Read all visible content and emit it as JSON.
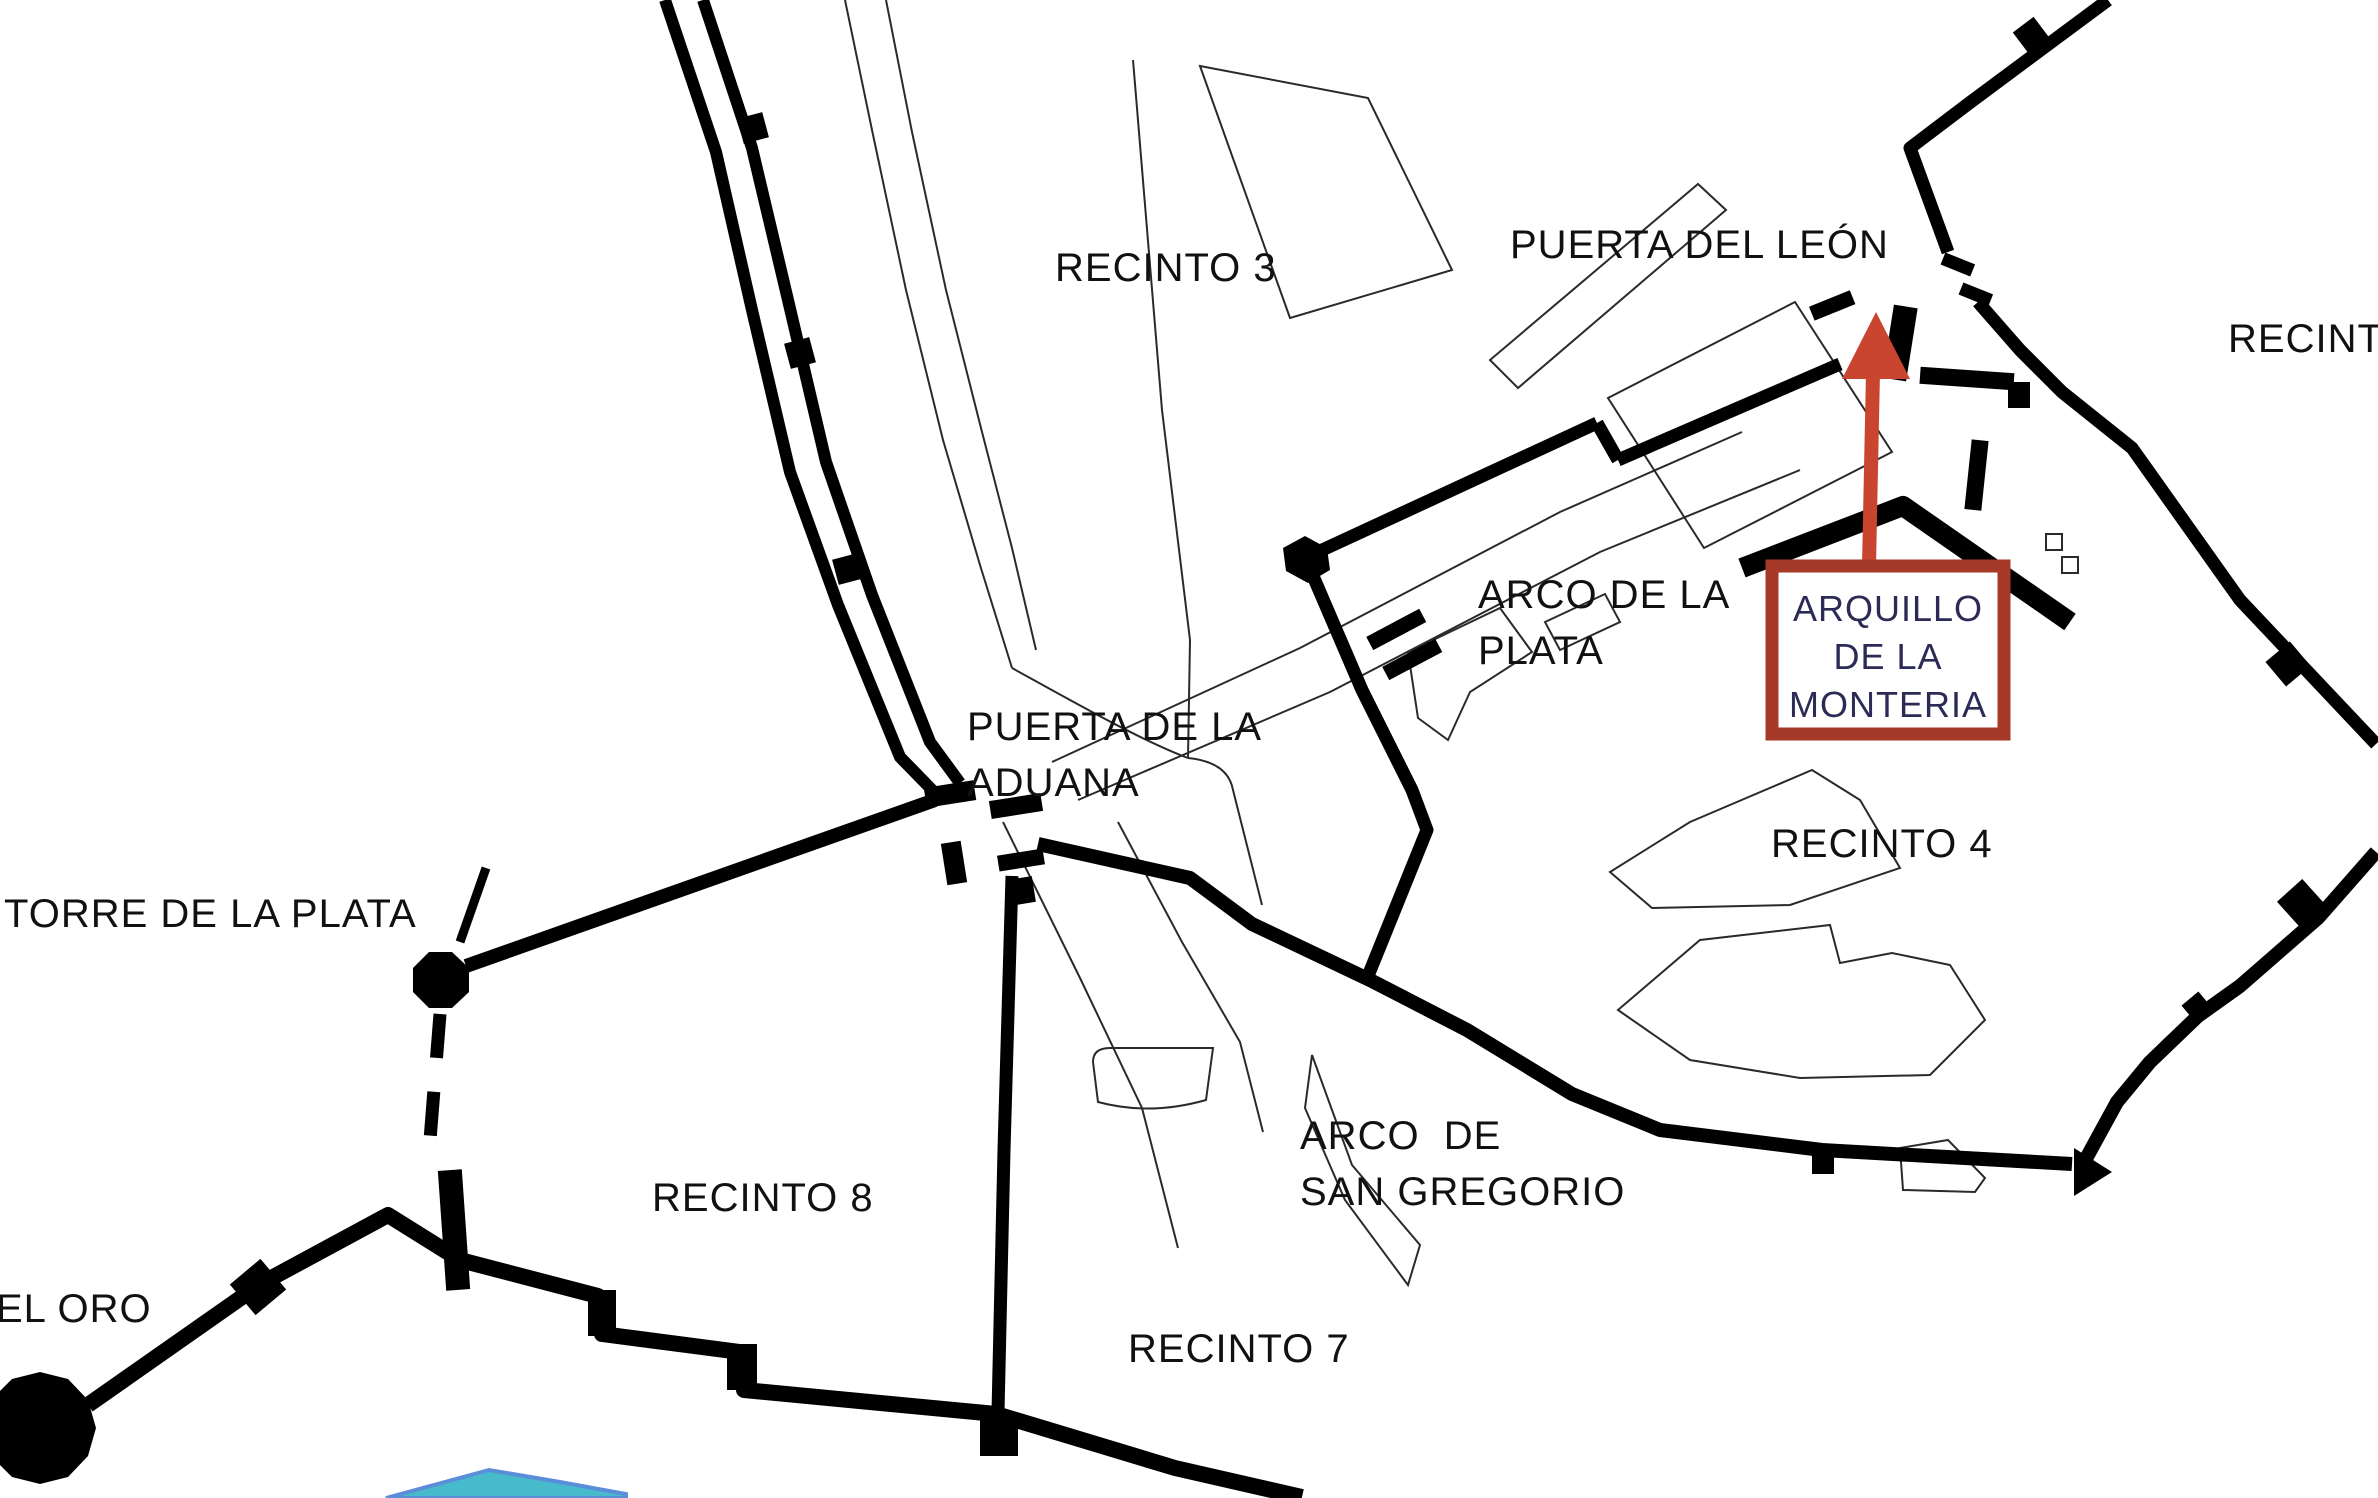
{
  "map": {
    "region_labels": {
      "recinto3": "RECINTO 3",
      "recinto4": "RECINTO 4",
      "recinto7": "RECINTO 7",
      "recinto8": "RECINTO 8",
      "recinto_right_partial": "RECINT"
    },
    "gate_labels": {
      "puerta_del_leon": "PUERTA DEL LEÓN",
      "arco_de_la_plata_line1": "ARCO DE LA",
      "arco_de_la_plata_line2": "PLATA",
      "puerta_de_la_aduana_line1": "PUERTA DE LA",
      "puerta_de_la_aduana_line2": "ADUANA",
      "arco_de_san_gregorio_line1": "ARCO  DE",
      "arco_de_san_gregorio_line2": "SAN GREGORIO"
    },
    "tower_labels": {
      "torre_de_la_plata": "TORRE DE LA PLATA",
      "torre_del_oro_partial": "EL ORO"
    }
  },
  "annotation": {
    "line1": "ARQUILLO",
    "line2": "DE LA",
    "line3": "MONTERIA",
    "box_border_color": "#A63A28",
    "box_fill": "#FFFFFF",
    "text_color": "#2B2B55",
    "arrow_color": "#C9452F"
  },
  "colors": {
    "wall": "#000000",
    "outline": "#2A2A2A",
    "label_text": "#111111",
    "water_fill": "#47BACB",
    "water_stroke": "#5B8ED9",
    "background": "#FFFFFF"
  }
}
